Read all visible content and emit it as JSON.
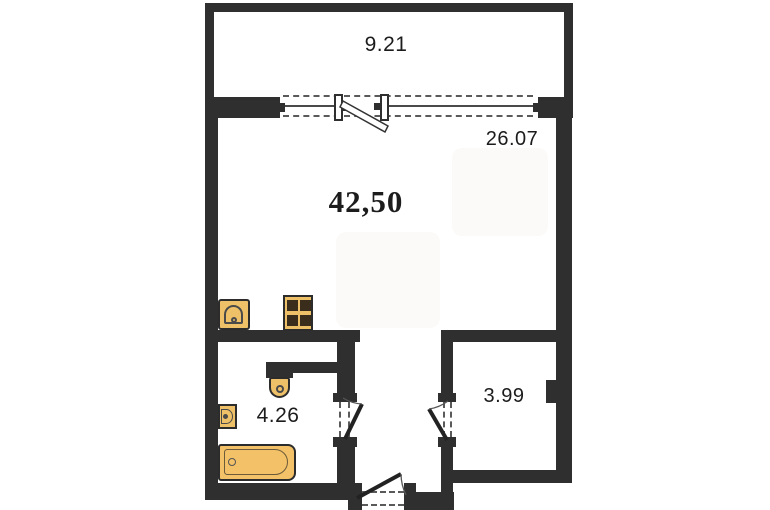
{
  "plan": {
    "type": "apartment-floor-plan",
    "total_area": "42,50",
    "rooms": [
      {
        "id": "balcony",
        "area": "9.21"
      },
      {
        "id": "living-kitchen",
        "area": "26.07"
      },
      {
        "id": "bathroom",
        "area": "4.26"
      },
      {
        "id": "storage",
        "area": "3.99"
      }
    ],
    "fixtures": [
      "kitchen-sink",
      "stove",
      "toilet",
      "wash-basin",
      "bathtub"
    ],
    "colors": {
      "wall": "#2f2f2f",
      "fixture_fill": "#eec169",
      "bathtub_fill": "#f3c268",
      "line": "#4a4a4a",
      "label": "#1c1c1c",
      "background": "#ffffff"
    }
  }
}
